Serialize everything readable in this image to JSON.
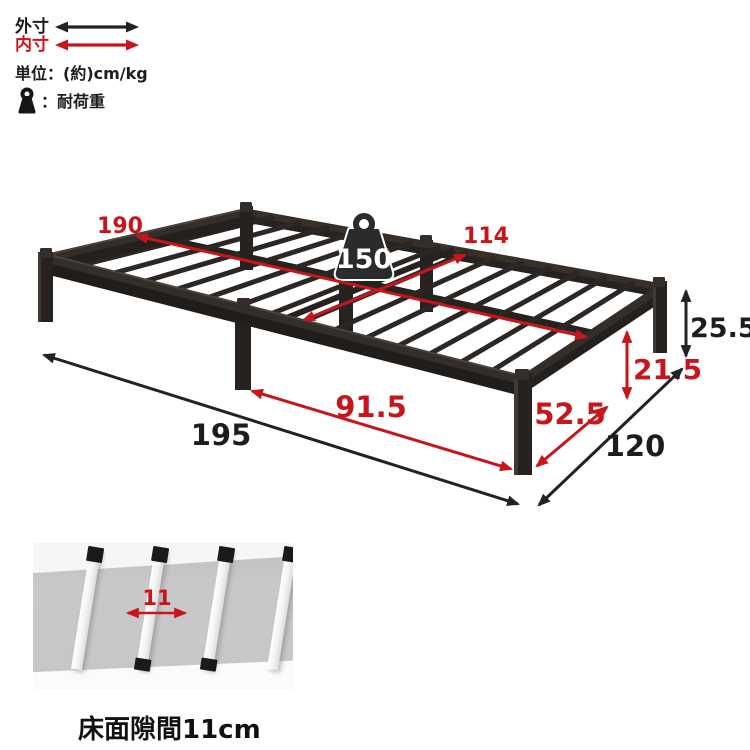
{
  "legend": {
    "outer_label": "外寸",
    "inner_label": "内寸",
    "unit_label": "単位：(約)cm/kg",
    "load_label": "：耐荷重"
  },
  "weight": {
    "capacity": "150"
  },
  "dims": {
    "inner_length": "190",
    "inner_width": "114",
    "outer_length": "195",
    "outer_width": "120",
    "total_height": "25.5",
    "under_clearance": "21.5",
    "leg_span_long": "91.5",
    "leg_span_short": "52.5"
  },
  "panel": {
    "gap_value": "11",
    "caption": "床面隙間11cm"
  },
  "colors": {
    "accent_red": "#c8151b",
    "ink_black": "#222222",
    "frame_dark": "#2e2927"
  }
}
